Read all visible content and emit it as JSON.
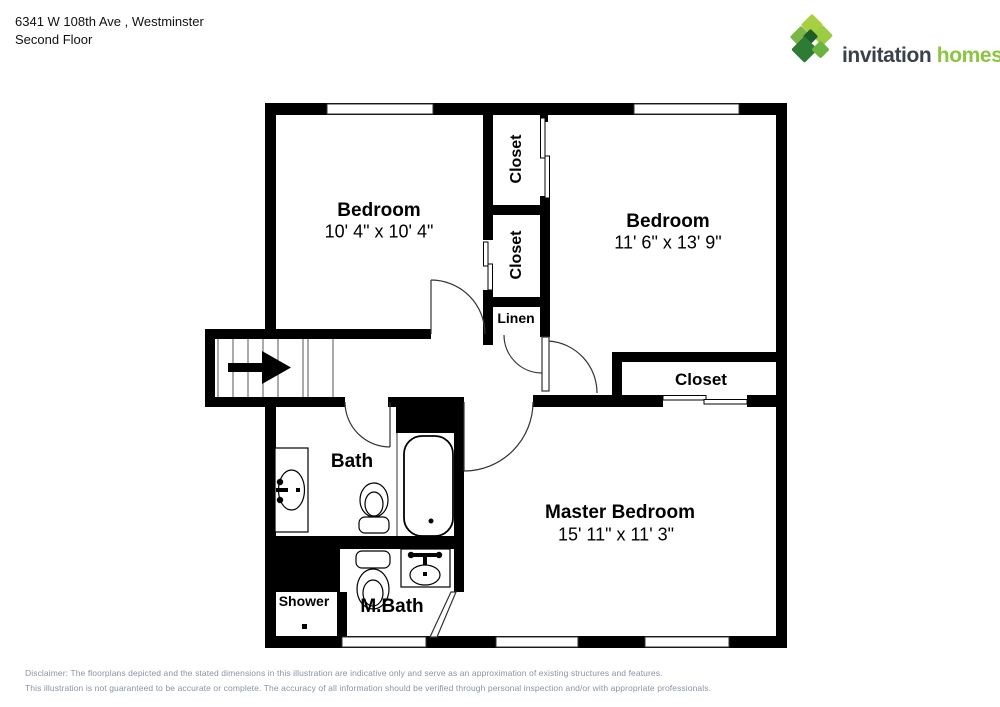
{
  "header": {
    "address": "6341 W 108th Ave , Westminster",
    "floor_label": "Second Floor"
  },
  "logo": {
    "word1": "invitation",
    "word2": "homes",
    "trademark": "™",
    "colors": {
      "light_green": "#a8cf3f",
      "mid_green": "#7ab648",
      "dark_green": "#2e7b35",
      "deep_green": "#1f5c28",
      "text_dark": "#39424a",
      "text_green": "#8cc540"
    }
  },
  "floorplan": {
    "rooms": {
      "bedroom_left": {
        "name": "Bedroom",
        "dims": "10' 4\" x 10' 4\""
      },
      "bedroom_right": {
        "name": "Bedroom",
        "dims": "11' 6\" x 13' 9\""
      },
      "master_bedroom": {
        "name": "Master Bedroom",
        "dims": "15' 11\" x 11' 3\""
      },
      "closet_top": {
        "name": "Closet"
      },
      "closet_mid": {
        "name": "Closet"
      },
      "closet_master": {
        "name": "Closet"
      },
      "linen": {
        "name": "Linen"
      },
      "bath": {
        "name": "Bath"
      },
      "master_bath": {
        "name": "M.Bath"
      },
      "shower": {
        "name": "Shower"
      }
    }
  },
  "footer": {
    "line1": "Disclaimer: The floorplans depicted and the stated dimensions in this illustration are indicative only and serve as an approximation of existing structures and features.",
    "line2": "This illustration is not guaranteed to be accurate or complete. The accuracy of all information should be verified through personal inspection and/or with appropriate professionals."
  }
}
